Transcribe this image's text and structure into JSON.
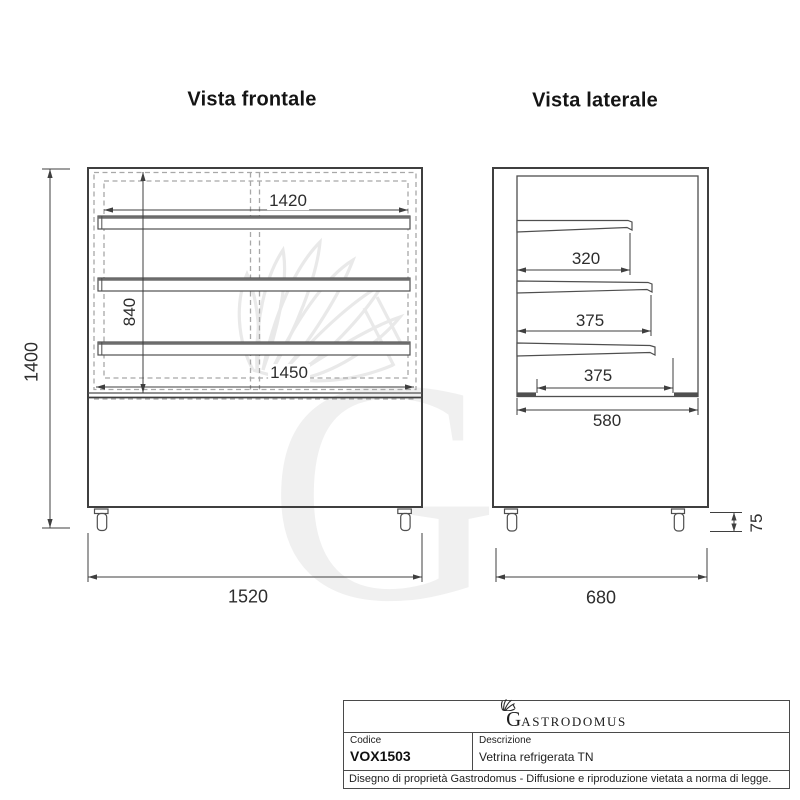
{
  "front_view": {
    "title": "Vista frontale",
    "dim_top_width": "1420",
    "dim_shelf_height": "840",
    "dim_inner_width": "1450",
    "dim_total_height": "1400",
    "dim_total_width": "1520"
  },
  "side_view": {
    "title": "Vista laterale",
    "dim_shelf1_depth": "320",
    "dim_shelf2_depth": "375",
    "dim_shelf3_depth": "375",
    "dim_inner_depth": "580",
    "dim_total_depth": "680",
    "dim_caster_height": "75"
  },
  "title_block": {
    "brand_initial": "G",
    "brand_rest": "ASTRODOMUS",
    "code_label": "Codice",
    "code_value": "VOX1503",
    "description_label": "Descrizione",
    "description_value": "Vetrina refrigerata TN",
    "legal_note": "Disegno di proprietà Gastrodomus -  Diffusione e riproduzione vietata a norma di legge."
  },
  "watermark": {
    "letter": "G"
  },
  "colors": {
    "line_dark": "#3f3f3f",
    "line_medium": "#4f4f4f",
    "dashed_gray": "#a8a8a8",
    "watermark_gray": "#efefef"
  }
}
